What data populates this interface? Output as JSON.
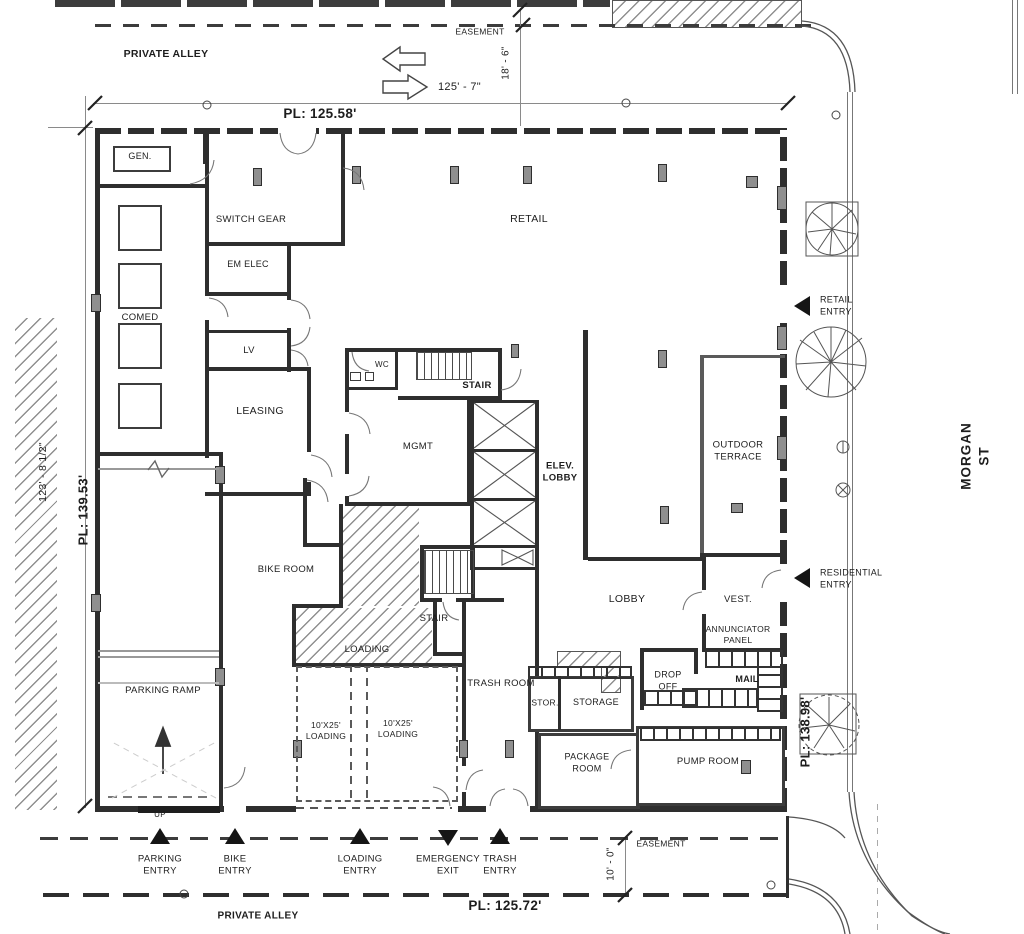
{
  "streets": {
    "private_alley_top": "PRIVATE ALLEY",
    "private_alley_bottom": "PRIVATE ALLEY",
    "morgan_st": "MORGAN ST"
  },
  "site": {
    "easement_top": "EASEMENT",
    "easement_bottom": "EASEMENT",
    "pl_north": "PL: 125.58'",
    "pl_west": "PL: 139.53'",
    "pl_east": "PL: 138.98'",
    "pl_south": "PL: 125.72'",
    "dim_alley_width": "125' - 7\"",
    "dim_easement_top": "18' - 6\"",
    "dim_lot_west": "123' - 8 1/2\"",
    "dim_easement_bottom": "10' - 0\""
  },
  "rooms": {
    "gen": "GEN.",
    "switch_gear": "SWITCH GEAR",
    "em_elec": "EM ELEC",
    "comed": "COMED",
    "lv": "LV",
    "leasing": "LEASING",
    "retail": "RETAIL",
    "wc": "WC",
    "stair_north": "STAIR",
    "mgmt": "MGMT",
    "elev_lobby": "ELEV.\nLOBBY",
    "outdoor_terrace": "OUTDOOR\nTERRACE",
    "bike_room": "BIKE ROOM",
    "stair_south": "STAIR",
    "loading": "LOADING",
    "loading_bay_1": "10'X25'\nLOADING",
    "loading_bay_2": "10'X25'\nLOADING",
    "trash_room": "TRASH ROOM",
    "lobby": "LOBBY",
    "vest": "VEST.",
    "annunciator_panel": "ANNUNCIATOR\nPANEL",
    "drop_off": "DROP\nOFF",
    "mail": "MAIL",
    "stor": "STOR.",
    "storage": "STORAGE",
    "package_room": "PACKAGE\nROOM",
    "pump_room": "PUMP ROOM",
    "parking_ramp": "PARKING RAMP",
    "up": "UP"
  },
  "entries": {
    "retail": "RETAIL\nENTRY",
    "residential": "RESIDENTIAL\nENTRY",
    "parking": "PARKING\nENTRY",
    "bike": "BIKE\nENTRY",
    "loading": "LOADING\nENTRY",
    "emergency_exit": "EMERGENCY\nEXIT",
    "trash": "TRASH\nENTRY"
  },
  "colors": {
    "line": "#2e2e2e",
    "paper": "#ffffff"
  }
}
